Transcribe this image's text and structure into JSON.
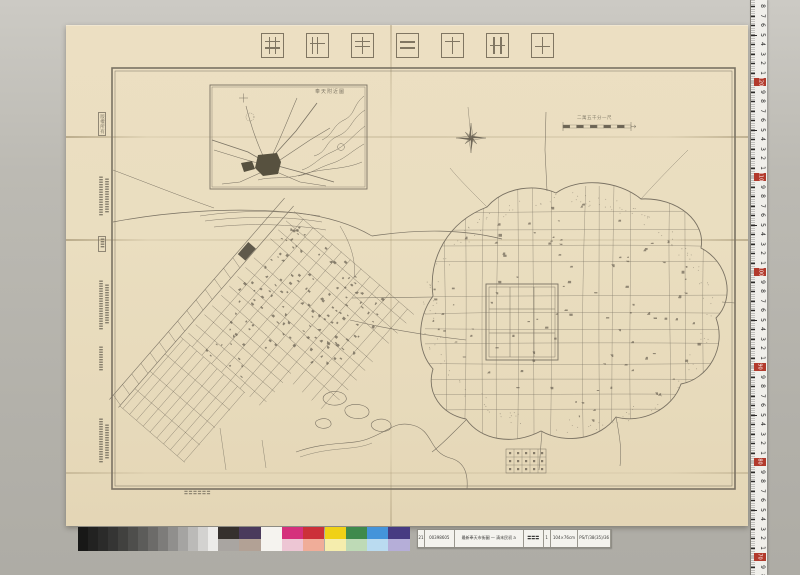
{
  "window": {
    "background_top": "#cccac4",
    "background_bottom": "#aeaca5"
  },
  "sheet": {
    "paper_color": "#eadec0",
    "ink_color": "#7a7263",
    "title_text": "最新奉天市街圖",
    "title_chars_displayed_right_to_left": [
      "圖",
      "街",
      "市",
      "天",
      "奉",
      "新",
      "最"
    ],
    "inset_title": "奉天附近圖",
    "scale_label": "二萬五千分一尺",
    "margin_note": "〓〓〓〓〓〓",
    "colophon_columns": [
      {
        "text": "版權所有",
        "y": 112,
        "h": 24,
        "boxed": true
      },
      {
        "text": "〓〓〓〓〓〓〓〓",
        "y": 176,
        "h": 42
      },
      {
        "text": "〓〓〓〓〓〓〓",
        "y": 178,
        "h": 38,
        "dx": 6
      },
      {
        "text": "〓〓",
        "y": 236,
        "h": 16,
        "boxed": true
      },
      {
        "text": "〓〓〓〓〓〓〓〓〓〓",
        "y": 280,
        "h": 54
      },
      {
        "text": "〓〓〓〓〓〓〓〓",
        "y": 284,
        "h": 46,
        "dx": 6
      },
      {
        "text": "〓〓〓〓〓",
        "y": 346,
        "h": 26
      },
      {
        "text": "〓〓〓〓〓〓〓〓〓",
        "y": 418,
        "h": 52
      },
      {
        "text": "〓〓〓〓〓〓〓",
        "y": 424,
        "h": 42,
        "dx": 6
      }
    ]
  },
  "ruler": {
    "tape_color": "#f0efea",
    "tick_color": "#2b2a28",
    "red_color": "#b23a2c",
    "red_values": [
      120,
      110,
      100,
      90,
      80,
      70
    ],
    "unit_digits_between": [
      9,
      8,
      7,
      6,
      5,
      4,
      3,
      2,
      1
    ]
  },
  "calibration": {
    "grayscale": [
      "#181817",
      "#222221",
      "#2b2b2a",
      "#353534",
      "#41413f",
      "#4e4e4c",
      "#5c5c5a",
      "#6c6b69",
      "#7d7c7a",
      "#908f8d",
      "#a5a4a2",
      "#bbbab8",
      "#d3d2d0",
      "#ecebe9"
    ],
    "colors_top": [
      "#35302d",
      "#4a3a5c",
      "#f5f3ef",
      "#d5307c",
      "#cc3039",
      "#f0d116",
      "#3f8a4c",
      "#4494da",
      "#473b82"
    ],
    "colors_bottom": [
      "#a9a5a1",
      "#b2a195",
      "#f5f3ef",
      "#edc6d4",
      "#f0ad99",
      "#f5edad",
      "#bedab6",
      "#badbf0",
      "#b5aed8"
    ]
  },
  "catalog_label": {
    "background": "#f4f3ee",
    "cells": [
      "21",
      "00398605",
      "最新奉天市街圖 一 清末民初 a",
      "〓〓〓",
      "1",
      "104×76cm",
      "PS/T/38(35)/36"
    ]
  }
}
